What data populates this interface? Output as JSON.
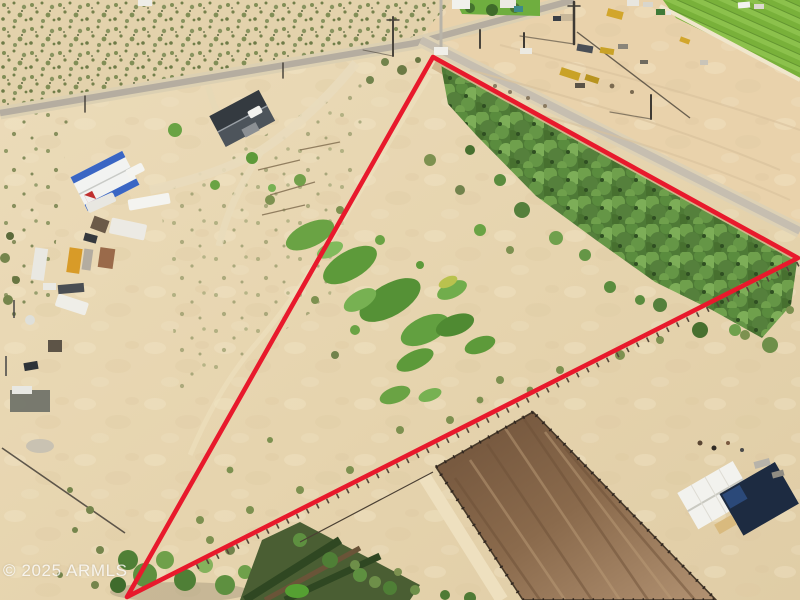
{
  "image": {
    "kind": "aerial-drone-photo",
    "watermark": "© 2025 ARMLS"
  },
  "boundary": {
    "shape": "triangle",
    "points_attr": "433,57 798,258 127,597",
    "color": "#e8192c"
  },
  "colors": {
    "sand": "#e6d5b1",
    "sand_light": "#f2e6c9",
    "farm_dirt": "#e8d0a9",
    "road_asphalt": "#b5ada0",
    "side_road": "#c6beb0",
    "scrub_olive": "#7c8a52",
    "wash_grass": "#5d9a3a",
    "tree_green": "#55803c",
    "crop_field": "#79b13a",
    "arena_dark": "#6f523a",
    "arena_light": "#b29272",
    "barn_white": "#f2f2ee",
    "barn_shade_navy": "#1d2b41",
    "workshop_blue": "#3a66c4",
    "workshop_logo_red": "#c03030",
    "house_roof_gray": "#42474d",
    "equipment_yellow": "#d2a62c",
    "trailer_orange": "#d89b28",
    "boundary_red": "#e8192c",
    "watermark_white": "#ffffff"
  }
}
